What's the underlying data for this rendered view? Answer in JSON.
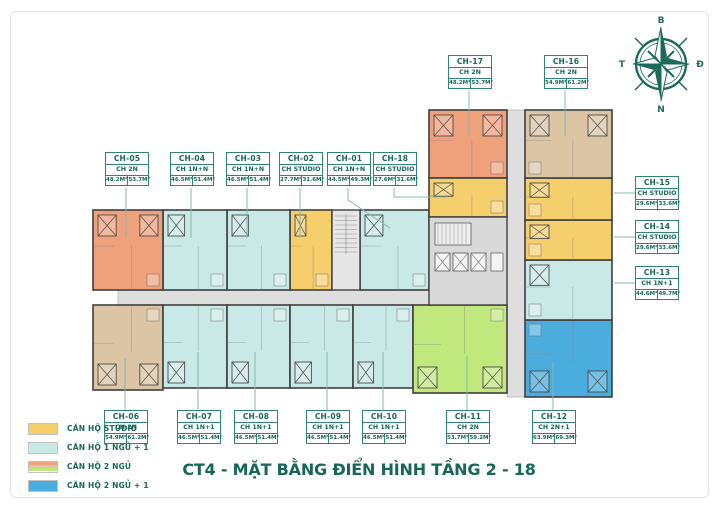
{
  "title": "CT4 - MẶT BẰNG ĐIỂN HÌNH TẦNG 2 - 18",
  "compass": {
    "north": "B",
    "east": "Đ",
    "south": "N",
    "west": "T"
  },
  "legend": {
    "items": [
      {
        "label": "CĂN HỘ STUDIO",
        "colors": [
          "#f5cf6b"
        ]
      },
      {
        "label": "CĂN HỘ 1 NGỦ + 1",
        "colors": [
          "#c8e9e5"
        ]
      },
      {
        "label": "CĂN HỘ 2 NGỦ",
        "colors": [
          "#efa17c",
          "#dbc5a4",
          "#c0e87d"
        ]
      },
      {
        "label": "CĂN HỘ 2 NGỦ + 1",
        "colors": [
          "#4badde"
        ]
      }
    ]
  },
  "plan": {
    "wall_color": "#3f3f3f",
    "corridor_color": "#dedede",
    "leader_color": "#86b8ac",
    "accent_text_color": "#156756",
    "palette": {
      "studio": "#f5cf6b",
      "one_bed": "#c8e9e5",
      "two_bed_orange": "#efa17c",
      "two_bed_tan": "#dbc5a4",
      "two_bed_green": "#c0e87d",
      "two_bed_plus": "#4badde"
    },
    "corridors": [
      [
        118,
        290,
        407,
        15
      ],
      [
        507,
        110,
        18,
        287
      ]
    ],
    "stair_block": [
      332,
      210,
      28,
      80
    ],
    "lift_core": [
      429,
      217,
      78,
      88
    ],
    "units": [
      {
        "id": "CH-01",
        "type": "CH 1N+N",
        "area1": "44.5M²",
        "area2": "49.3M²",
        "color": "one_bed",
        "rect": [
          360,
          210,
          69,
          80
        ],
        "label": [
          327,
          152
        ],
        "leader": [
          [
            348,
            188
          ],
          [
            348,
            200
          ],
          [
            390,
            228
          ]
        ]
      },
      {
        "id": "CH-02",
        "type": "CH STUDIO",
        "area1": "27.7M²",
        "area2": "31.6M²",
        "color": "studio",
        "rect": [
          290,
          210,
          42,
          80
        ],
        "label": [
          279,
          152
        ],
        "leader": [
          [
            300,
            188
          ],
          [
            300,
            238
          ]
        ]
      },
      {
        "id": "CH-03",
        "type": "CH 1N+N",
        "area1": "46.5M²",
        "area2": "51.4M²",
        "color": "one_bed",
        "rect": [
          227,
          210,
          63,
          80
        ],
        "label": [
          226,
          152
        ],
        "leader": [
          [
            247,
            188
          ],
          [
            247,
            238
          ]
        ]
      },
      {
        "id": "CH-04",
        "type": "CH 1N+N",
        "area1": "46.5M²",
        "area2": "51.4M²",
        "color": "one_bed",
        "rect": [
          163,
          210,
          64,
          80
        ],
        "label": [
          170,
          152
        ],
        "leader": [
          [
            191,
            188
          ],
          [
            191,
            238
          ]
        ]
      },
      {
        "id": "CH-05",
        "type": "CH 2N",
        "area1": "48.2M²",
        "area2": "53.7M²",
        "color": "two_bed_orange",
        "rect": [
          93,
          210,
          70,
          80
        ],
        "label": [
          105,
          152
        ],
        "leader": [
          [
            126,
            188
          ],
          [
            126,
            238
          ]
        ]
      },
      {
        "id": "CH-06",
        "type": "CH 2N",
        "area1": "54.9M²",
        "area2": "61.2M²",
        "color": "two_bed_tan",
        "rect": [
          93,
          305,
          70,
          85
        ],
        "label": [
          104,
          410
        ],
        "leader": [
          [
            125,
            410
          ],
          [
            125,
            358
          ]
        ]
      },
      {
        "id": "CH-07",
        "type": "CH 1N+1",
        "area1": "46.5M²",
        "area2": "51.4M²",
        "color": "one_bed",
        "rect": [
          163,
          305,
          64,
          83
        ],
        "label": [
          177,
          410
        ],
        "leader": [
          [
            198,
            410
          ],
          [
            198,
            352
          ]
        ]
      },
      {
        "id": "CH-08",
        "type": "CH 1N+1",
        "area1": "46.5M²",
        "area2": "51.4M²",
        "color": "one_bed",
        "rect": [
          227,
          305,
          63,
          83
        ],
        "label": [
          234,
          410
        ],
        "leader": [
          [
            255,
            410
          ],
          [
            255,
            352
          ]
        ]
      },
      {
        "id": "CH-09",
        "type": "CH 1N+1",
        "area1": "46.5M²",
        "area2": "51.4M²",
        "color": "one_bed",
        "rect": [
          290,
          305,
          63,
          83
        ],
        "label": [
          306,
          410
        ],
        "leader": [
          [
            327,
            410
          ],
          [
            327,
            352
          ]
        ]
      },
      {
        "id": "CH-10",
        "type": "CH 1N+1",
        "area1": "46.5M²",
        "area2": "51.4M²",
        "color": "one_bed",
        "rect": [
          353,
          305,
          60,
          83
        ],
        "label": [
          362,
          410
        ],
        "leader": [
          [
            383,
            410
          ],
          [
            383,
            352
          ]
        ]
      },
      {
        "id": "CH-11",
        "type": "CH 2N",
        "area1": "53.7M²",
        "area2": "59.2M²",
        "color": "two_bed_green",
        "rect": [
          413,
          305,
          94,
          88
        ],
        "label": [
          446,
          410
        ],
        "leader": [
          [
            467,
            410
          ],
          [
            467,
            356
          ]
        ]
      },
      {
        "id": "CH-12",
        "type": "CH 2N+1",
        "area1": "63.9M²",
        "area2": "69.3M²",
        "color": "two_bed_plus",
        "rect": [
          525,
          320,
          87,
          77
        ],
        "label": [
          532,
          410
        ],
        "leader": [
          [
            553,
            410
          ],
          [
            553,
            362
          ]
        ]
      },
      {
        "id": "CH-13",
        "type": "CH 1N+1",
        "area1": "44.6M²",
        "area2": "49.7M²",
        "color": "one_bed",
        "rect": [
          525,
          260,
          87,
          60
        ],
        "label": [
          635,
          266
        ],
        "leader": [
          [
            635,
            283
          ],
          [
            614,
            283
          ]
        ]
      },
      {
        "id": "CH-14",
        "type": "CH STUDIO",
        "area1": "29.6M²",
        "area2": "33.6M²",
        "color": "studio",
        "rect": [
          525,
          220,
          87,
          40
        ],
        "label": [
          635,
          220
        ],
        "leader": [
          [
            635,
            237
          ],
          [
            614,
            237
          ]
        ]
      },
      {
        "id": "CH-15",
        "type": "CH STUDIO",
        "area1": "29.6M²",
        "area2": "33.6M²",
        "color": "studio",
        "rect": [
          525,
          178,
          87,
          42
        ],
        "label": [
          635,
          176
        ],
        "leader": [
          [
            635,
            193
          ],
          [
            614,
            193
          ]
        ]
      },
      {
        "id": "CH-16",
        "type": "CH 2N",
        "area1": "54.9M²",
        "area2": "61.2M²",
        "color": "two_bed_tan",
        "rect": [
          525,
          110,
          87,
          68
        ],
        "label": [
          544,
          55
        ],
        "leader": [
          [
            565,
            91
          ],
          [
            565,
            136
          ]
        ]
      },
      {
        "id": "CH-17",
        "type": "CH 2N",
        "area1": "48.2M²",
        "area2": "53.7M²",
        "color": "two_bed_orange",
        "rect": [
          429,
          110,
          78,
          68
        ],
        "label": [
          448,
          55
        ],
        "leader": [
          [
            469,
            91
          ],
          [
            469,
            136
          ]
        ]
      },
      {
        "id": "CH-18",
        "type": "CH STUDIO",
        "area1": "27.6M²",
        "area2": "31.6M²",
        "color": "studio",
        "rect": [
          429,
          178,
          78,
          39
        ],
        "label": [
          373,
          152
        ],
        "leader": [
          [
            394,
            188
          ],
          [
            394,
            197
          ],
          [
            446,
            197
          ]
        ]
      }
    ]
  }
}
